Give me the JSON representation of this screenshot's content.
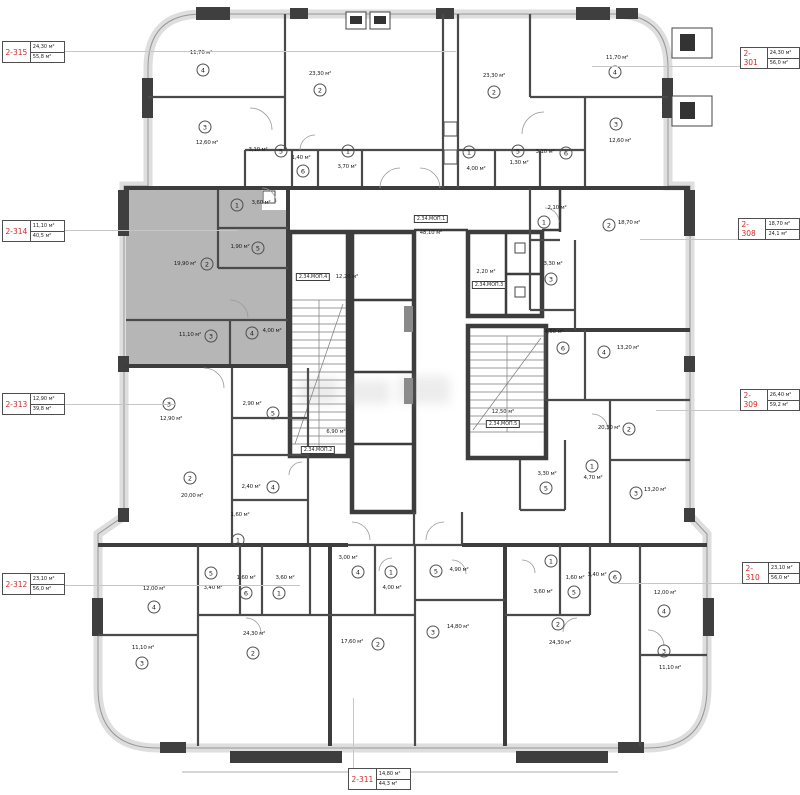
{
  "units": "м²",
  "colors": {
    "tag_number": "#d02a2a",
    "wall_dark": "#3d3d3d",
    "envelope": "#dedede",
    "highlight": "#b6b6b6"
  },
  "apartment_tags": [
    {
      "id": "2-315",
      "a1": "24,30 м²",
      "a2": "55,8 м²",
      "x": 2,
      "y": 41,
      "leader": [
        62,
        51,
        456,
        51
      ]
    },
    {
      "id": "2-314",
      "a1": "11,10 м²",
      "a2": "40,5 м²",
      "x": 2,
      "y": 220,
      "leader": [
        62,
        230,
        238,
        230
      ]
    },
    {
      "id": "2-313",
      "a1": "12,90 м²",
      "a2": "39,8 м²",
      "x": 2,
      "y": 393,
      "leader": [
        62,
        404,
        176,
        404
      ]
    },
    {
      "id": "2-312",
      "a1": "23,10 м²",
      "a2": "56,0 м²",
      "x": 2,
      "y": 573,
      "leader": [
        62,
        585,
        300,
        585
      ]
    },
    {
      "id": "2-301",
      "a1": "24,30 м²",
      "a2": "56,0 м²",
      "x": 740,
      "y": 47,
      "leader": [
        592,
        66,
        740,
        66
      ]
    },
    {
      "id": "2-308",
      "a1": "18,70 м²",
      "a2": "24,1 м²",
      "x": 738,
      "y": 218,
      "leader": [
        640,
        239,
        738,
        239
      ]
    },
    {
      "id": "2-309",
      "a1": "26,40 м²",
      "a2": "59,2 м²",
      "x": 740,
      "y": 389,
      "leader": [
        656,
        410,
        740,
        410
      ]
    },
    {
      "id": "2-310",
      "a1": "23,10 м²",
      "a2": "56,0 м²",
      "x": 742,
      "y": 562,
      "leader": [
        618,
        583,
        742,
        583
      ]
    },
    {
      "id": "2-311",
      "a1": "14,80 м²",
      "a2": "44,3 м²",
      "x": 348,
      "y": 768,
      "leader": [
        353,
        698,
        353,
        768
      ]
    }
  ],
  "rooms": [
    {
      "apt": "2-315",
      "n": "4",
      "area": "11,70 м²",
      "t": [
        201,
        53
      ],
      "c": [
        203,
        70
      ]
    },
    {
      "apt": "2-315",
      "n": "2",
      "area": "23,30 м²",
      "t": [
        320,
        74
      ],
      "c": [
        320,
        90
      ]
    },
    {
      "apt": "2-315",
      "n": "3",
      "area": "12,60 м²",
      "t": [
        207,
        143
      ],
      "c": [
        205,
        127
      ]
    },
    {
      "apt": "2-315",
      "n": "5",
      "area": "3,10 м²",
      "t": [
        258,
        150
      ],
      "c": [
        281,
        151
      ]
    },
    {
      "apt": "2-315",
      "n": "6",
      "area": "1,40 м²",
      "t": [
        301,
        158
      ],
      "c": [
        303,
        171
      ]
    },
    {
      "apt": "2-315",
      "n": "1",
      "area": "3,70 м²",
      "t": [
        347,
        167
      ],
      "c": [
        348,
        151
      ]
    },
    {
      "apt": "2-301",
      "n": "2",
      "area": "23,30 м²",
      "t": [
        494,
        76
      ],
      "c": [
        494,
        92
      ]
    },
    {
      "apt": "2-301",
      "n": "4",
      "area": "11,70 м²",
      "t": [
        617,
        58
      ],
      "c": [
        615,
        72
      ]
    },
    {
      "apt": "2-301",
      "n": "3",
      "area": "12,60 м²",
      "t": [
        620,
        141
      ],
      "c": [
        616,
        124
      ]
    },
    {
      "apt": "2-301",
      "n": "1",
      "area": "4,00 м²",
      "t": [
        476,
        169
      ],
      "c": [
        469,
        152
      ]
    },
    {
      "apt": "2-301",
      "n": "5",
      "area": "1,30 м²",
      "t": [
        519,
        163
      ],
      "c": [
        518,
        151
      ]
    },
    {
      "apt": "2-301",
      "n": "6",
      "area": "3,10 м²",
      "t": [
        545,
        152
      ],
      "c": [
        566,
        153
      ]
    },
    {
      "apt": "2-314",
      "n": "1",
      "area": "3,60 м²",
      "t": [
        261,
        203
      ],
      "c": [
        237,
        205
      ]
    },
    {
      "apt": "2-314",
      "n": "5",
      "area": "1,90 м²",
      "t": [
        240,
        247
      ],
      "c": [
        258,
        248
      ]
    },
    {
      "apt": "2-314",
      "n": "2",
      "area": "19,90 м²",
      "t": [
        185,
        264
      ],
      "c": [
        207,
        264
      ]
    },
    {
      "apt": "2-314",
      "n": "3",
      "area": "11,10 м²",
      "t": [
        190,
        335
      ],
      "c": [
        211,
        336
      ]
    },
    {
      "apt": "2-314",
      "n": "4",
      "area": "4,00 м²",
      "t": [
        272,
        331
      ],
      "c": [
        252,
        333
      ]
    },
    {
      "apt": "2-308",
      "n": "1",
      "area": "2,10 м²",
      "t": [
        557,
        208
      ],
      "c": [
        544,
        222
      ]
    },
    {
      "apt": "2-308",
      "n": "2",
      "area": "18,70 м²",
      "t": [
        629,
        223
      ],
      "c": [
        609,
        225
      ]
    },
    {
      "apt": "2-308",
      "n": "3",
      "area": "3,30 м²",
      "t": [
        553,
        264
      ],
      "c": [
        551,
        279
      ]
    },
    {
      "apt": "2-309",
      "n": "6",
      "area": "4,50 м²",
      "t": [
        554,
        332
      ],
      "c": [
        563,
        348
      ]
    },
    {
      "apt": "2-309",
      "n": "4",
      "area": "13,20 м²",
      "t": [
        628,
        348
      ],
      "c": [
        604,
        352
      ]
    },
    {
      "apt": "2-309",
      "n": "2",
      "area": "20,30 м²",
      "t": [
        609,
        428
      ],
      "c": [
        629,
        429
      ]
    },
    {
      "apt": "2-309",
      "n": "1",
      "area": "4,70 м²",
      "t": [
        593,
        478
      ],
      "c": [
        592,
        466
      ]
    },
    {
      "apt": "2-309",
      "n": "5",
      "area": "3,30 м²",
      "t": [
        547,
        474
      ],
      "c": [
        546,
        488
      ]
    },
    {
      "apt": "2-309",
      "n": "3",
      "area": "13,20 м²",
      "t": [
        655,
        490
      ],
      "c": [
        636,
        493
      ]
    },
    {
      "apt": "2-313",
      "n": "3",
      "area": "12,90 м²",
      "t": [
        171,
        419
      ],
      "c": [
        169,
        404
      ]
    },
    {
      "apt": "2-313",
      "n": "5",
      "area": "2,90 м²",
      "t": [
        252,
        404
      ],
      "c": [
        273,
        413
      ]
    },
    {
      "apt": "2-313",
      "n": "2",
      "area": "20,00 м²",
      "t": [
        192,
        496
      ],
      "c": [
        190,
        478
      ]
    },
    {
      "apt": "2-313",
      "n": "4",
      "area": "2,40 м²",
      "t": [
        251,
        487
      ],
      "c": [
        273,
        487
      ]
    },
    {
      "apt": "2-313",
      "n": "1",
      "area": "1,60 м²",
      "t": [
        240,
        515
      ],
      "c": [
        238,
        540
      ]
    },
    {
      "apt": "2-312",
      "n": "4",
      "area": "12,00 м²",
      "t": [
        154,
        589
      ],
      "c": [
        154,
        607
      ]
    },
    {
      "apt": "2-312",
      "n": "5",
      "area": "3,40 м²",
      "t": [
        213,
        588
      ],
      "c": [
        211,
        573
      ]
    },
    {
      "apt": "2-312",
      "n": "6",
      "area": "1,60 м²",
      "t": [
        246,
        578
      ],
      "c": [
        246,
        593
      ]
    },
    {
      "apt": "2-312",
      "n": "1",
      "area": "3,60 м²",
      "t": [
        285,
        578
      ],
      "c": [
        279,
        593
      ]
    },
    {
      "apt": "2-312",
      "n": "3",
      "area": "11,10 м²",
      "t": [
        143,
        648
      ],
      "c": [
        142,
        663
      ]
    },
    {
      "apt": "2-312",
      "n": "2",
      "area": "24,30 м²",
      "t": [
        254,
        634
      ],
      "c": [
        253,
        653
      ]
    },
    {
      "apt": "2-311",
      "n": "4",
      "area": "3,00 м²",
      "t": [
        348,
        558
      ],
      "c": [
        358,
        572
      ]
    },
    {
      "apt": "2-311",
      "n": "1",
      "area": "4,00 м²",
      "t": [
        392,
        588
      ],
      "c": [
        391,
        572
      ]
    },
    {
      "apt": "2-311",
      "n": "5",
      "area": "4,90 м²",
      "t": [
        459,
        570
      ],
      "c": [
        436,
        571
      ]
    },
    {
      "apt": "2-311",
      "n": "3",
      "area": "14,80 м²",
      "t": [
        458,
        627
      ],
      "c": [
        433,
        632
      ]
    },
    {
      "apt": "2-311",
      "n": "2",
      "area": "17,60 м²",
      "t": [
        352,
        642
      ],
      "c": [
        378,
        644
      ]
    },
    {
      "apt": "2-310",
      "n": "1",
      "area": "3,60 м²",
      "t": [
        543,
        592
      ],
      "c": [
        551,
        561
      ]
    },
    {
      "apt": "2-310",
      "n": "5",
      "area": "1,60 м²",
      "t": [
        575,
        578
      ],
      "c": [
        574,
        592
      ]
    },
    {
      "apt": "2-310",
      "n": "6",
      "area": "3,40 м²",
      "t": [
        597,
        575
      ],
      "c": [
        615,
        577
      ]
    },
    {
      "apt": "2-310",
      "n": "2",
      "area": "24,30 м²",
      "t": [
        560,
        643
      ],
      "c": [
        558,
        624
      ]
    },
    {
      "apt": "2-310",
      "n": "4",
      "area": "12,00 м²",
      "t": [
        665,
        593
      ],
      "c": [
        664,
        611
      ]
    },
    {
      "apt": "2-310",
      "n": "3",
      "area": "11,10 м²",
      "t": [
        670,
        668
      ],
      "c": [
        664,
        651
      ]
    }
  ],
  "core_labels": [
    {
      "label": "2.34.МОП.1",
      "area": "48,10 м²",
      "box": [
        431,
        219
      ],
      "at": [
        431,
        233
      ]
    },
    {
      "label": "2.34.МОП.4",
      "area": "12,20 м²",
      "box": [
        313,
        277
      ],
      "at": [
        347,
        277
      ]
    },
    {
      "label": "2.34.МОП.3",
      "area": "2,20 м²",
      "box": [
        489,
        285
      ],
      "at": [
        486,
        272
      ]
    },
    {
      "label": "2.34.МОП.2",
      "area": "6,90 м²",
      "box": [
        318,
        450
      ],
      "at": [
        336,
        432
      ]
    },
    {
      "label": "2.34.МОП.5",
      "area": "12,50 м²",
      "box": [
        503,
        424
      ],
      "at": [
        503,
        412
      ]
    }
  ]
}
